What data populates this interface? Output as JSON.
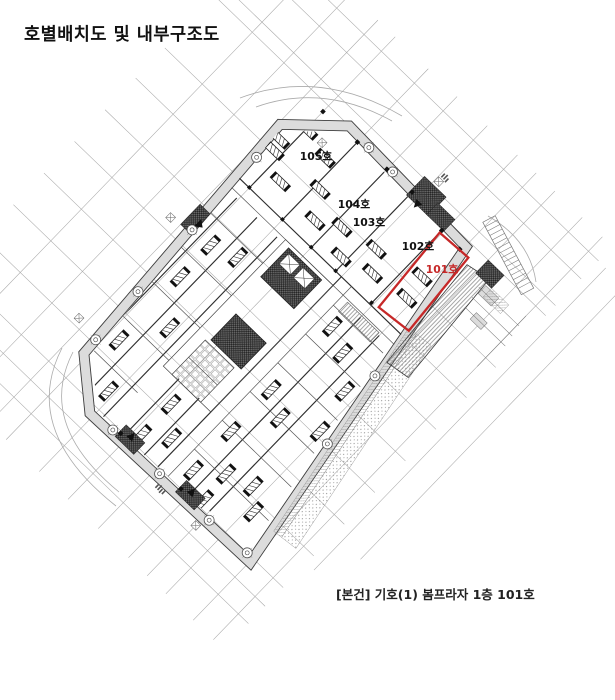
{
  "page": {
    "title": "호별배치도 및 내부구조도",
    "caption": "[본건] 기호(1) 봄프라자 1층 101호"
  },
  "floor_plan": {
    "type": "unit-layout-and-interior-structure-drawing",
    "floor": "1층",
    "subject_unit": "101호",
    "highlight_color": "#c62828",
    "units": [
      {
        "label": "105호",
        "highlighted": false
      },
      {
        "label": "104호",
        "highlighted": false
      },
      {
        "label": "103호",
        "highlighted": false
      },
      {
        "label": "102호",
        "highlighted": false
      },
      {
        "label": "101호",
        "highlighted": true
      }
    ]
  }
}
